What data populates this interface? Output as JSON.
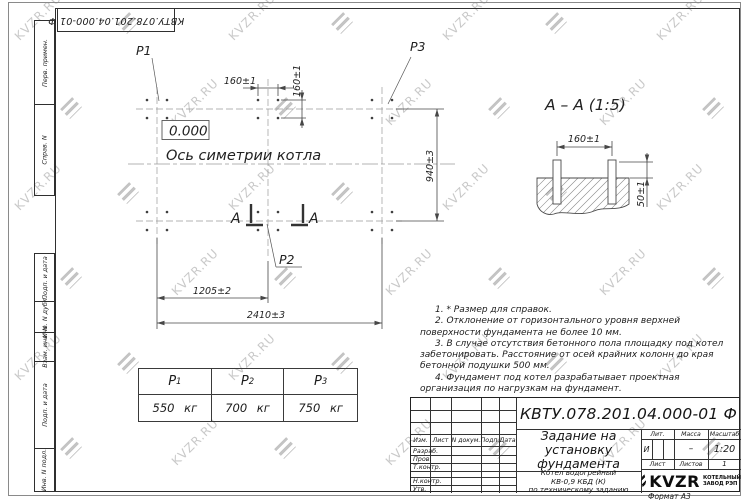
{
  "watermark": {
    "text": "KVZR.RU"
  },
  "designation": "КВТУ.078.201.04.000-01 Ф",
  "frame_labels": [
    "Перв. примен.",
    "Справ. N",
    "Подп. и дата",
    "Инв. N дубл.",
    "Взам. инв. N",
    "Подп. и дата",
    "Инв. N подл."
  ],
  "plan": {
    "p1": "P1",
    "p2": "P2",
    "p3": "P3",
    "elevation": "0.000",
    "axis_label": "Ось симетрии котла",
    "dim_bolt_spacing_x": "160±1",
    "dim_bolt_spacing_y": "160±1",
    "dim_row_spacing": "940±3",
    "dim_half_length": "1205±2",
    "dim_total_length": "2410±3",
    "section_letter_left": "А",
    "section_letter_right": "А"
  },
  "section_view": {
    "title": "А – А (1:5)",
    "dim_bolt_spacing": "160±1",
    "dim_bolt_height": "50±1"
  },
  "notes": [
    "1. * Размер для справок.",
    "2. Отклонение от горизонтального уровня верхней поверхности фундамента не более 10 мм.",
    "3. В случае отсутствия бетонного пола площадку под котел забетонировать. Расстояние от осей крайних колонн до края бетонной подушки 500 мм.",
    "4. Фундамент под котел разрабатывает проектная организация по нагрузкам на фундамент."
  ],
  "load_table": {
    "headers": [
      {
        "name": "P",
        "index": "1"
      },
      {
        "name": "P",
        "index": "2"
      },
      {
        "name": "P",
        "index": "3"
      }
    ],
    "values": [
      "550 кг",
      "700 кг",
      "750 кг"
    ]
  },
  "title_block": {
    "doc_title": "Задание на установку фундамента",
    "product_lines": [
      "Котел водогрейный",
      "КВ-0,9 КБД (К)",
      "по техническому заданию"
    ],
    "col_headers": [
      "Изм.",
      "Лист",
      "N докум.",
      "Подп.",
      "Дата"
    ],
    "sig_labels": [
      "Разраб.",
      "Пров.",
      "Т.контр.",
      "Н.контр.",
      "Утв."
    ],
    "lit_header": "Лит.",
    "mass_header": "Масса",
    "scale_header": "Масштаб",
    "lit_value": "И",
    "mass_value": "–",
    "scale_value": "1:20",
    "sheet_label": "Лист",
    "sheets_label": "Листов",
    "sheets_value": "1",
    "company_name": "KVZR",
    "company_line1": "КОТЕЛЬНЫЙ",
    "company_line2": "ЗАВОД РЭП",
    "format_label": "Формат А3"
  }
}
